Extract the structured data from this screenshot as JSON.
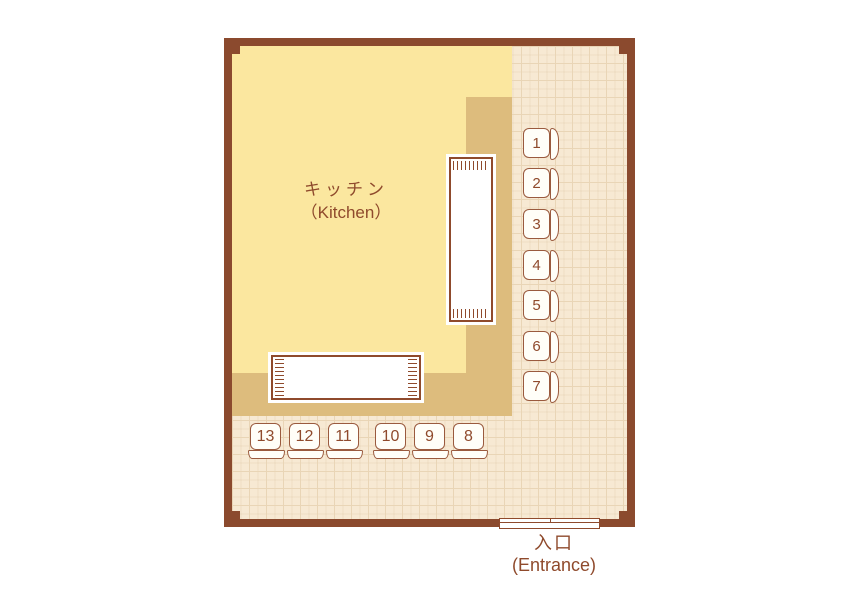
{
  "labels": {
    "kitchen_jp": "キッチン",
    "kitchen_en": "（Kitchen）",
    "entrance_jp": "入口",
    "entrance_en": "(Entrance)"
  },
  "seats": {
    "right_column": [
      {
        "number": "1",
        "top": 82
      },
      {
        "number": "2",
        "top": 122
      },
      {
        "number": "3",
        "top": 163
      },
      {
        "number": "4",
        "top": 204
      },
      {
        "number": "5",
        "top": 244
      },
      {
        "number": "6",
        "top": 285
      },
      {
        "number": "7",
        "top": 325
      }
    ],
    "bottom_row": [
      {
        "number": "13",
        "left": 18
      },
      {
        "number": "12",
        "left": 57
      },
      {
        "number": "11",
        "left": 96
      },
      {
        "number": "10",
        "left": 143
      },
      {
        "number": "9",
        "left": 182
      },
      {
        "number": "8",
        "left": 221
      }
    ]
  },
  "colors": {
    "wall": "#8B4A2E",
    "floor": "#F7E9D3",
    "floor_grid": "#E9D5B6",
    "kitchen": "#FBE79F",
    "counter": "#DDBC7D",
    "line": "#8F4A2C",
    "seat_border": "#9A5A3E",
    "seat_fill": "#FFFEF8",
    "text": "#8F4A2C"
  }
}
